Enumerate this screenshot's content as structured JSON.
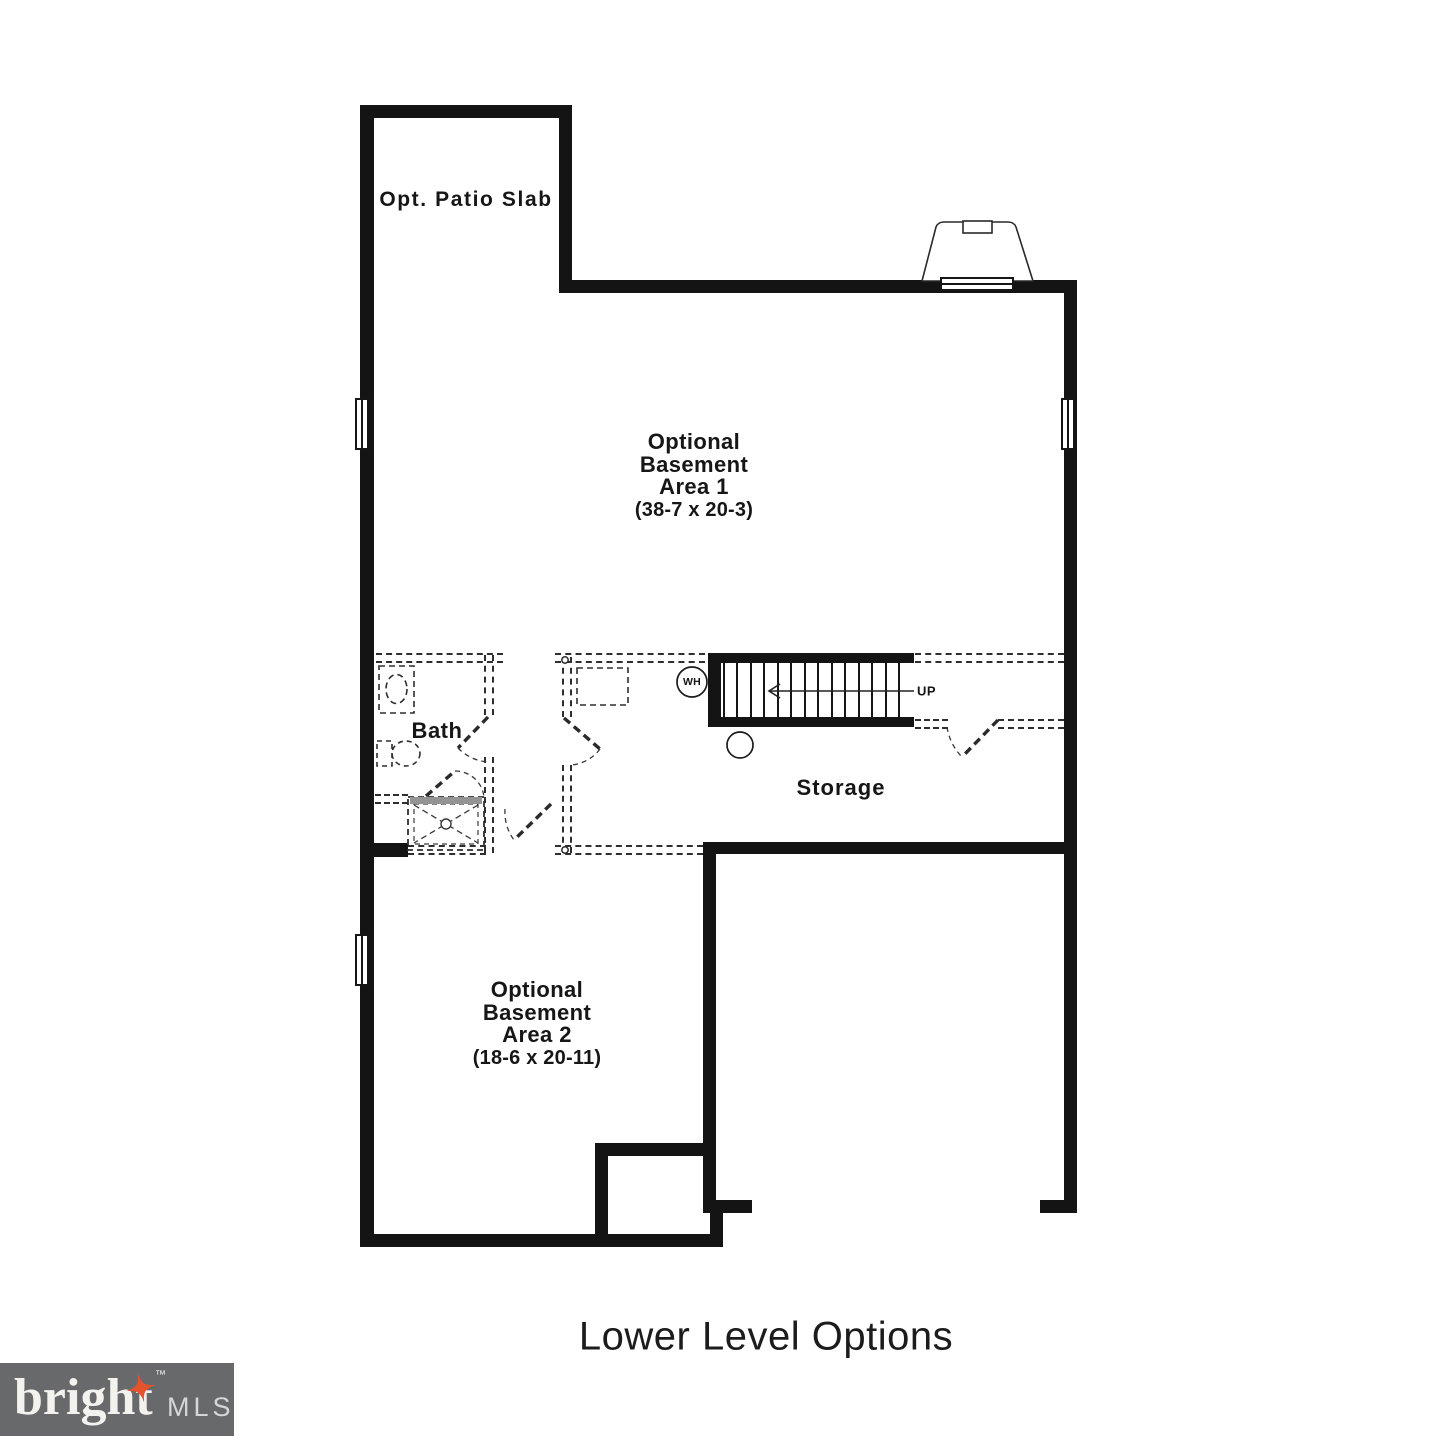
{
  "plan": {
    "patio": {
      "label": "Opt. Patio Slab"
    },
    "area1": {
      "label": "Optional\nBasement\nArea 1",
      "dims": "(38-7 x 20-3)"
    },
    "bath": {
      "label": "Bath"
    },
    "storage": {
      "label": "Storage"
    },
    "stairs": {
      "up_label": "UP"
    },
    "water_heater": {
      "label": "WH"
    },
    "area2": {
      "label": "Optional\nBasement\nArea 2",
      "dims": "(18-6 x 20-11)"
    }
  },
  "title": "Lower Level Options",
  "logo": {
    "brand": "bright",
    "trademark": "™",
    "suffix": "MLS"
  },
  "colors": {
    "wall": "#141414",
    "dashed_wall": "#2e2e2e",
    "logo_background": "#68696b",
    "logo_star": "#e4532c",
    "logo_brand_text": "#f4f2ee",
    "logo_suffix_text": "#d5d6d7"
  }
}
